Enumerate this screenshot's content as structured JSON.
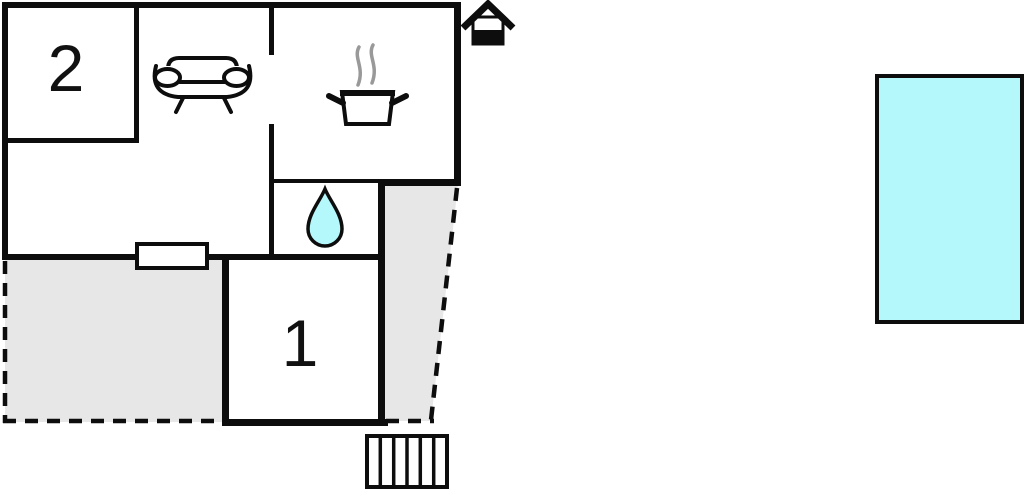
{
  "floorplan": {
    "room_labels": {
      "room2": "2",
      "room1": "1"
    },
    "icons": {
      "sofa": "sofa-icon",
      "cooking_pot": "cooking-pot-icon",
      "steam": "steam-icon",
      "water_drop": "water-drop-icon",
      "house": "house-icon",
      "stairs": "stairs-icon",
      "window": "window-symbol"
    },
    "colors": {
      "wall": "#0d0d0d",
      "outdoor_fill": "#e7e7e7",
      "water": "#b5f8fb",
      "steam": "#999999",
      "background": "#ffffff"
    }
  }
}
